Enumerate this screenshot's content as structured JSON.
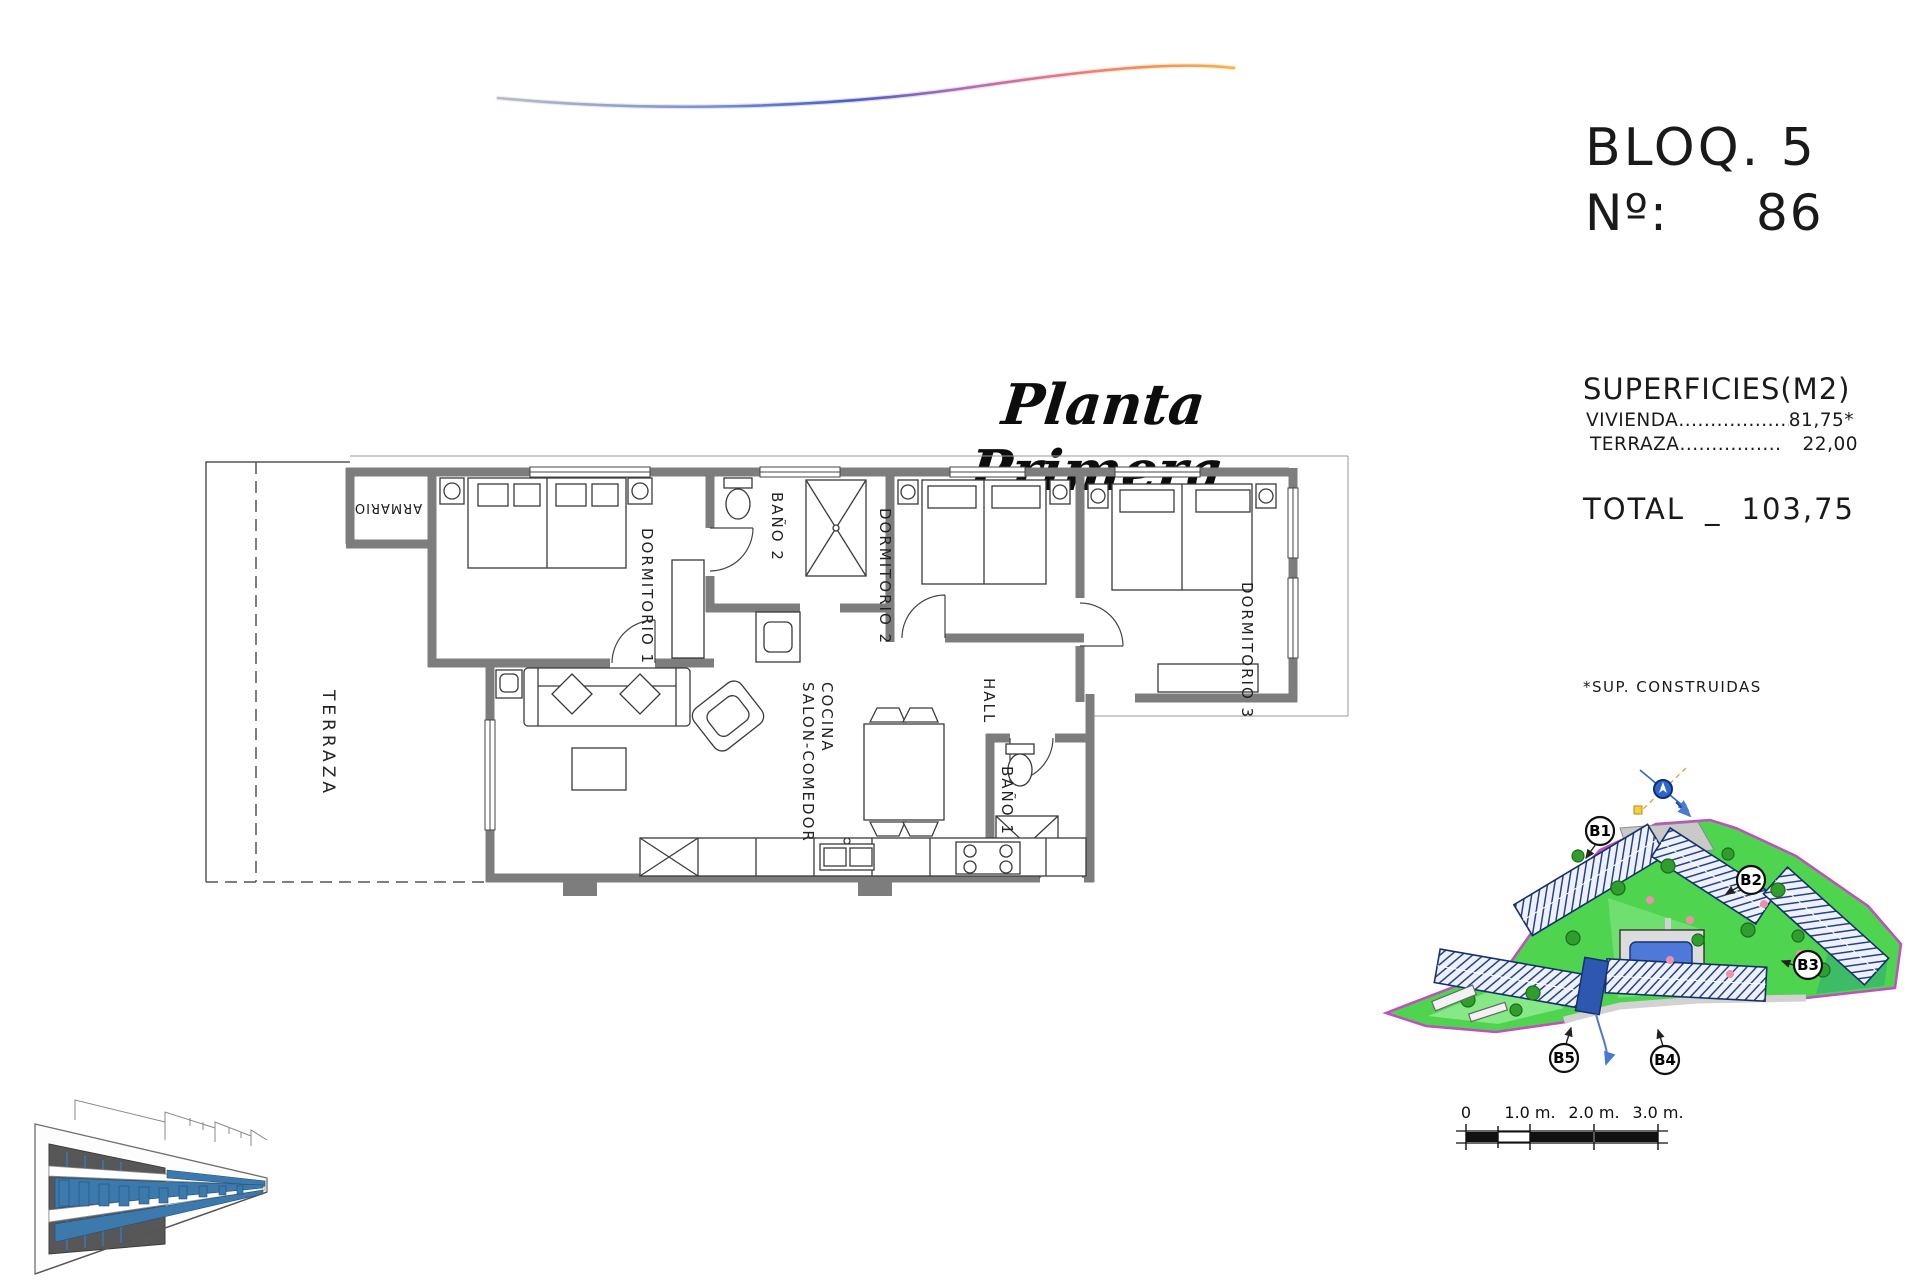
{
  "sheet": {
    "bloq": "BLOQ. 5",
    "numero_label": "Nº:",
    "numero_value": "86",
    "plan_title": "Planta Primera"
  },
  "superficies": {
    "heading": "SUPERFICIES(M2)",
    "rows": [
      {
        "name": "VIVIENDA",
        "dots": "....................",
        "value": "81,75*"
      },
      {
        "name": "TERRAZA",
        "dots": "................",
        "value": "22,00"
      }
    ],
    "total_label": "TOTAL",
    "total_separator": "_",
    "total_value": "103,75",
    "footnote": "*SUP. CONSTRUIDAS"
  },
  "floorplan": {
    "labels": {
      "terraza": "TERRAZA",
      "armario": "ARMARIO",
      "dormitorio1": "DORMITORIO 1",
      "bano2": "BAÑO 2",
      "dormitorio2": "DORMITORIO 2",
      "dormitorio3": "DORMITORIO 3",
      "hall": "HALL",
      "salon1": "SALON-COMEDOR",
      "salon2": "COCINA",
      "bano1": "BAÑO 1"
    }
  },
  "siteplan": {
    "blocks": [
      "B1",
      "B2",
      "B3",
      "B4",
      "B5"
    ],
    "scalebar_labels": [
      "0",
      "1.0 m.",
      "2.0 m.",
      "3.0 m."
    ]
  },
  "colors": {
    "site_green": "#4ed44e",
    "site_green_light": "#86e886",
    "boundary_magenta": "#c24ec2",
    "building_navy": "#23418c",
    "pool_blue": "#4f79d8",
    "highlight_blue": "#2e57b0",
    "wall_gray": "#7d7d7d",
    "swoosh_blue": "#4a5fc0",
    "swoosh_orange": "#f4a24a"
  }
}
